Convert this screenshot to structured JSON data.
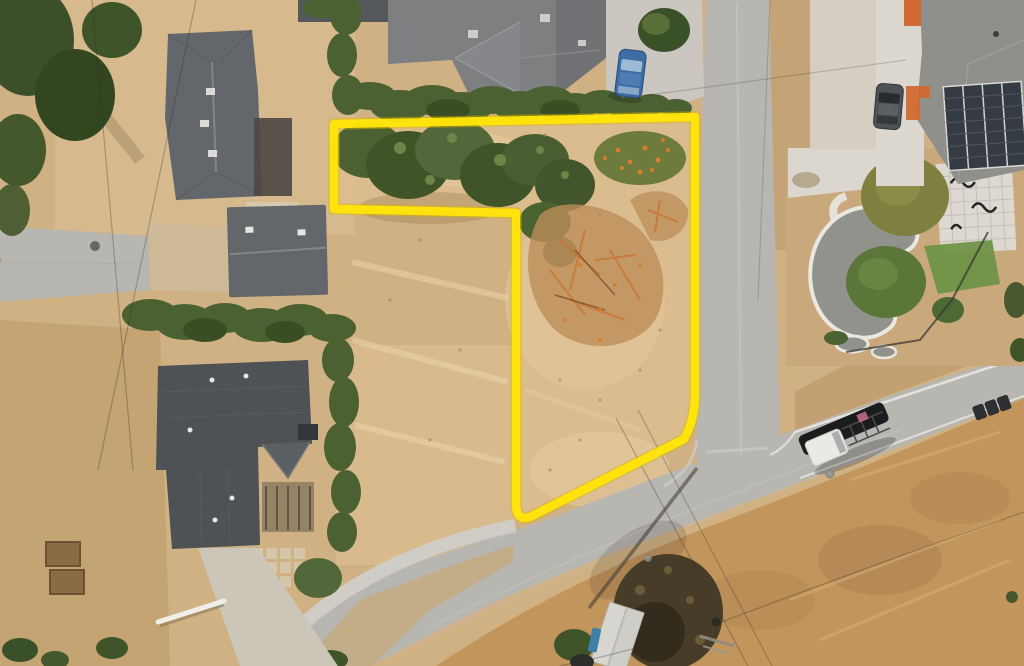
{
  "meta": {
    "kind": "aerial-drone-photograph",
    "subject": "vacant corner parcel outlined in yellow in a residential neighborhood",
    "width_px": 1024,
    "height_px": 666
  },
  "property_boundary": {
    "name": "highlighted-parcel-outline",
    "shape": "L-shaped lot with rounded corner toward the street intersection",
    "stroke_width": 8.5,
    "vertices_px": [
      [
        334,
        124
      ],
      [
        695,
        117
      ],
      [
        695,
        394
      ],
      [
        684,
        439
      ],
      [
        534,
        515
      ],
      [
        516,
        505
      ],
      [
        516,
        213
      ],
      [
        334,
        209
      ]
    ]
  },
  "objects": [
    {
      "name": "vacant-lot",
      "desc": "dry golden grass, green shrub mass at top, orange dead branches in center"
    },
    {
      "name": "house-top-left",
      "desc": "gray hip-roof house with rear patio"
    },
    {
      "name": "house-middle-left",
      "desc": "small gray gable-roof house"
    },
    {
      "name": "house-bottom-left",
      "desc": "large dark-gray roof house with deck, pavers and driveway"
    },
    {
      "name": "house-top-center",
      "desc": "gray roof house with driveway and parked blue car"
    },
    {
      "name": "house-top-right",
      "desc": "gray roof house with rooftop solar array and orange accents"
    },
    {
      "name": "landscaped-yard",
      "desc": "sculpted gray ponds with white edging, paver patio, lawn, trees"
    },
    {
      "name": "street-vertical",
      "desc": "concrete residential street running top to intersection"
    },
    {
      "name": "street-diagonal",
      "desc": "cross street running from bottom left to right edge"
    },
    {
      "name": "street-left",
      "desc": "short gray street / driveway at left edge"
    },
    {
      "name": "car-blue",
      "desc": "blue car parked on driveway top center"
    },
    {
      "name": "car-gray",
      "desc": "gray car parked beside top-right house"
    },
    {
      "name": "truck-white",
      "desc": "white pickup with black ladder rack driving on cross street"
    },
    {
      "name": "trash-bins",
      "desc": "three dark bins at road edge right side"
    },
    {
      "name": "utility-pole",
      "desc": "utility pole with long shadow across intersection"
    },
    {
      "name": "power-lines",
      "desc": "thin overhead wires crossing scene"
    },
    {
      "name": "shed",
      "desc": "small light-roof shed at bottom center with blue item"
    },
    {
      "name": "raised-beds",
      "desc": "two wooden raised garden beds bottom left"
    },
    {
      "name": "conifer-trees",
      "desc": "dark conifers in top-left corner"
    }
  ],
  "colors": {
    "ground_base": "#d0b183",
    "ground_pale": "#e4cfa4",
    "field_orange": "#c2955c",
    "lot_grass": "#dcbe90",
    "road": "#b8b6b1",
    "road_light": "#c7c5bf",
    "sidewalk": "#d0cdc6",
    "concrete": "#dbd7cf",
    "roof_dark": "#4e5255",
    "roof_mid": "#63676b",
    "roof_light": "#7d7f81",
    "roof_pale": "#8f8f8b",
    "hedge": "#4c6132",
    "tree_dark": "#3a5028",
    "tree_olive": "#7d803f",
    "lawn": "#6f9448",
    "bush_red": "#96422c",
    "debris": "#bd8d57",
    "branch_orange": "#c87637",
    "flower_orange": "#d47f2e",
    "accent_orange": "#d06a32",
    "solar": "#343b42",
    "car_blue": "#3e6ca5",
    "car_gray": "#4d5256",
    "van_white": "#ebe9e4",
    "rack_black": "#1b1c1e",
    "pond": "#90928b",
    "paver": "#ddd9d0",
    "boundary": "#ffe40a",
    "boundary_shadow": "#d9b400",
    "wire": "#2f2e2b",
    "shadow": "#3e3a30"
  }
}
